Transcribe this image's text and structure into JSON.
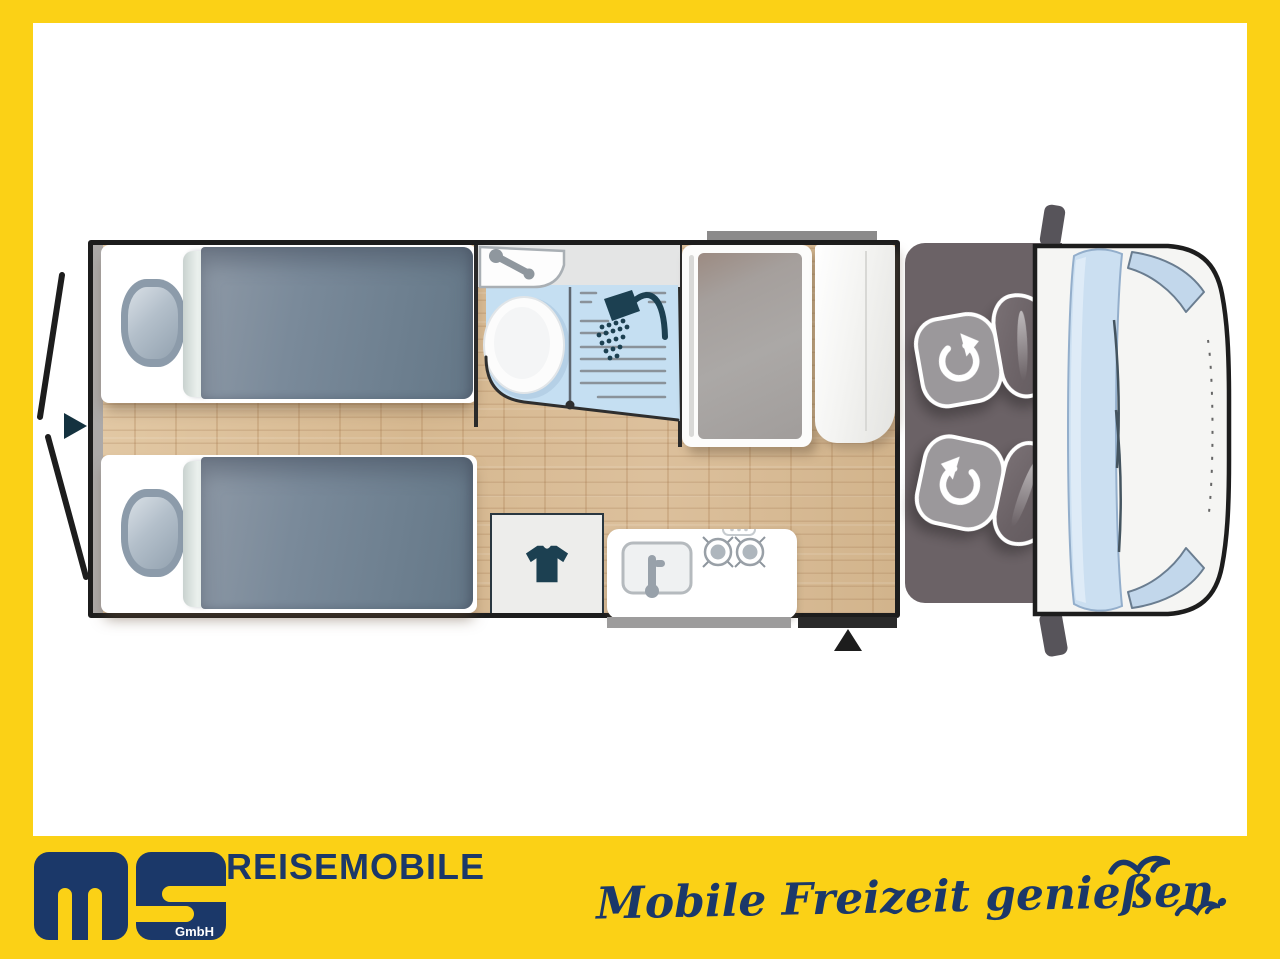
{
  "brand": {
    "logo_text": "ms",
    "company_suffix": "GmbH",
    "wordmark": "REISEMOBILE",
    "tagline": "Mobile Freizeit genießen."
  },
  "palette": {
    "frame_yellow": "#FBD116",
    "brand_navy": "#1B3869",
    "outline_black": "#1D1D1D",
    "cab_gray": "#6B6266",
    "wood_tan": "#DBBF9A",
    "bath_blue": "#C5DFF2",
    "icon_teal": "#1C4051",
    "vehicle_body_white": "#F5F5F3",
    "windshield_blue": "#CBDFF1"
  },
  "icons": {
    "shower": "shower-head-icon",
    "clothes": "t-shirt-icon",
    "swivel_seat": "rotate-arrow-icon",
    "rear_entry": "right-triangle-marker",
    "side_entry": "up-triangle-marker",
    "birds": "seagull-icon"
  }
}
